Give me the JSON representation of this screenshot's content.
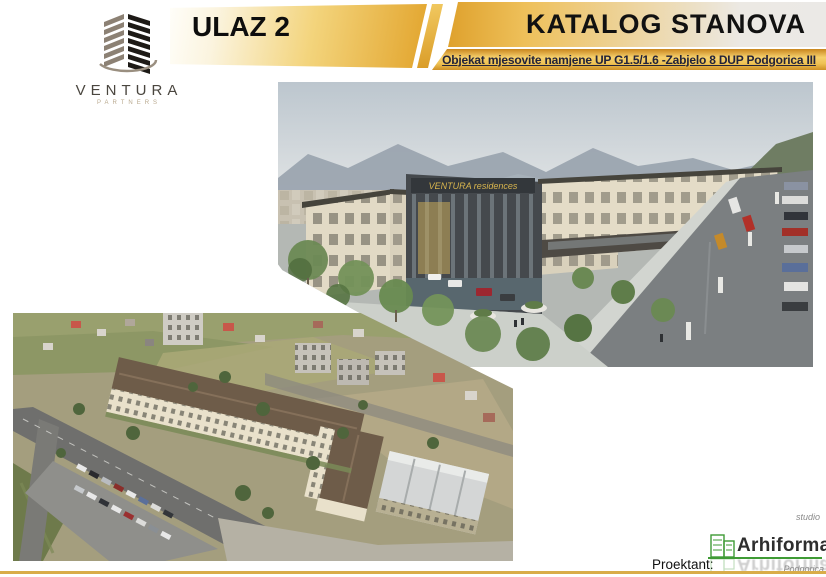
{
  "brand": {
    "name": "VENTURA",
    "tagline": "PARTNERS"
  },
  "header": {
    "entrance_label": "ULAZ 2",
    "title": "KATALOG STANOVA",
    "subtitle": "Objekat mjesovite namjene UP G1.5/1.6  -Zabjelo 8 DUP Podgorica III"
  },
  "render_image": {
    "description": "3D render: mixed-use complex with dark glass corner tower and cream apartment wings along a tree-lined boulevard, mountains behind",
    "sign_text": "VENTURA residences"
  },
  "aerial_image": {
    "description": "Aerial drone photo: L-shaped apartment block under construction, roads, parking rows and surrounding neighbourhood"
  },
  "footer": {
    "designer_label": "Proektant:",
    "studio_prefix": "studio",
    "studio_name": "Arhiforma",
    "studio_city": "Podgorica"
  },
  "colors": {
    "accent_gold": "#e2a72e",
    "band_gray": "#e9e7e3",
    "subtitle_text": "#232339",
    "logo_green": "#3f9b35",
    "bottom_rule_gold": "#d9ad49",
    "sign_gold": "#d8b54e"
  }
}
